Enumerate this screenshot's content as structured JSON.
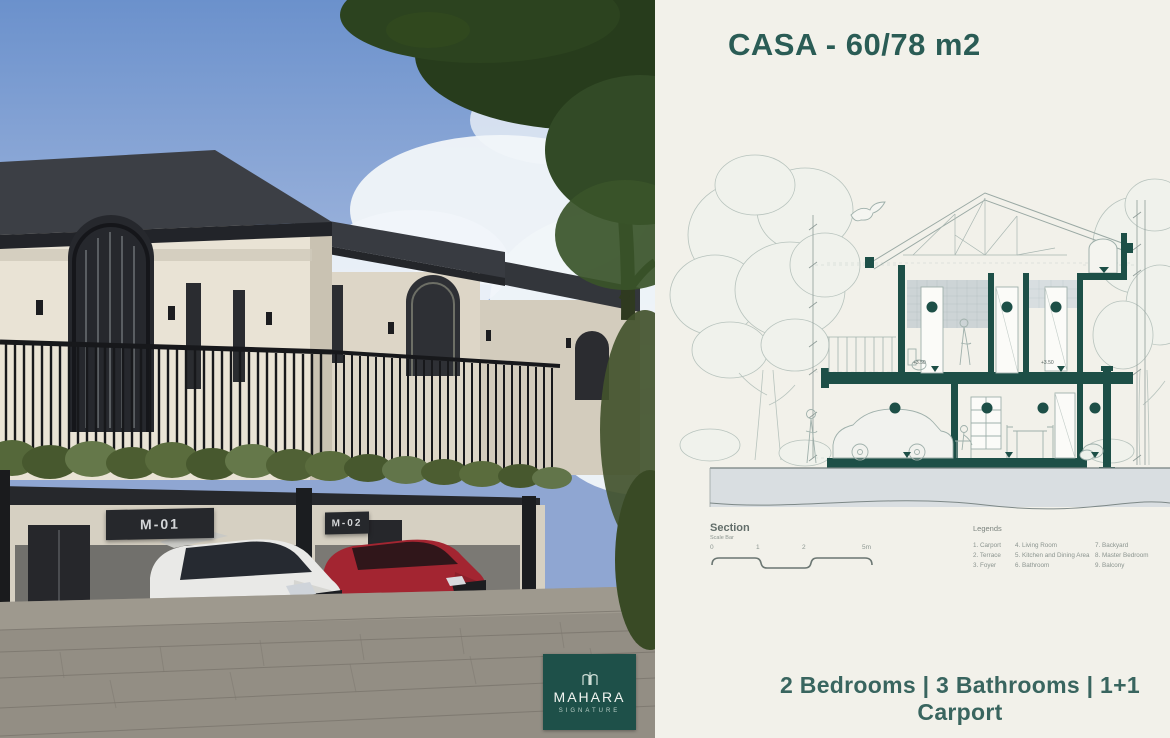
{
  "photo": {
    "unit_signs": [
      {
        "label": "M-01"
      },
      {
        "label": "M-02"
      }
    ],
    "badge": {
      "brand": "MAHARA",
      "tagline": "SIGNATURE"
    }
  },
  "info": {
    "title": "CASA - 60/78 m2",
    "drawing": {
      "section_label": "Section",
      "scale_bar_label": "Scale Bar",
      "scale_ticks": [
        "0",
        "1",
        "2",
        "5m"
      ],
      "level_label": "+3.50"
    },
    "legends": {
      "title": "Legends",
      "columns": [
        [
          "1. Carport",
          "2. Terrace",
          "3. Foyer"
        ],
        [
          "4. Living Room",
          "5. Kitchen and Dining Area",
          "6. Bathroom"
        ],
        [
          "7. Backyard",
          "8. Master Bedroom",
          "9. Balcony"
        ]
      ]
    },
    "footer": "2 Bedrooms | 3 Bathrooms | 1+1 Carport"
  },
  "colors": {
    "structure_teal": "#1d4f47",
    "title_text": "#2a5c55",
    "panel_background": "#f2f1ea",
    "ground_band": "#d9dee1"
  }
}
